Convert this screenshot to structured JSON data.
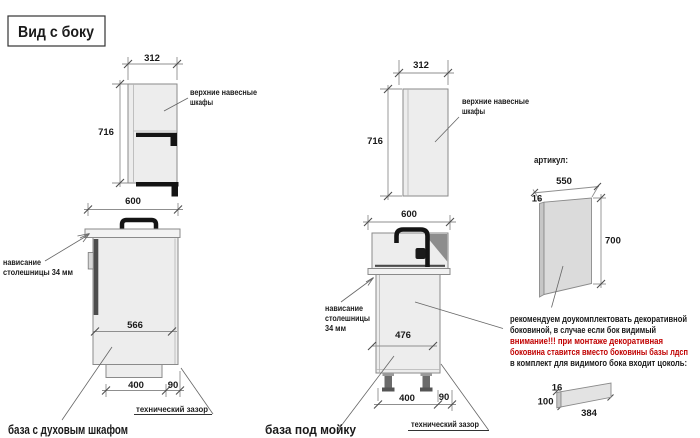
{
  "title": "Вид с боку",
  "colors": {
    "warning_red": "#c00000",
    "ink": "#1a1a1a",
    "drawing_line": "#8a8a8a",
    "cabinet_fill": "#ededed"
  },
  "upper_cabinet_left": {
    "width": "312",
    "height": "716",
    "label_line1": "верхние навесные",
    "label_line2": "шкафы"
  },
  "upper_cabinet_mid": {
    "width": "312",
    "height": "716",
    "label_line1": "верхние навесные",
    "label_line2": "шкафы"
  },
  "oven_base": {
    "top_width": "600",
    "inner_depth": "566",
    "plinth_width": "400",
    "tech_gap": "90",
    "overhang_line1": "нависание",
    "overhang_line2": "столешницы 34 мм",
    "tech_gap_label": "технический зазор",
    "caption": "база с духовым шкафом"
  },
  "sink_base": {
    "top_width": "600",
    "inner_depth": "476",
    "plinth_width": "400",
    "tech_gap": "90",
    "overhang_line1": "нависание",
    "overhang_line2": "столешницы",
    "overhang_line3": "34 мм",
    "tech_gap_label": "технический зазор",
    "caption": "база под мойку"
  },
  "decor_panel": {
    "header": "артикул:",
    "width": "550",
    "thickness": "16",
    "height": "700"
  },
  "note": {
    "line1": "рекомендуем доукомплектовать декоративной",
    "line2": "боковиной, в случае если бок видимый",
    "line3": "внимание!!! при монтаже декоративная",
    "line4": "боковина ставится вместо боковины базы лдсп",
    "line5": "в комплект для видимого бока входит цоколь:"
  },
  "plinth_part": {
    "thickness": "16",
    "height": "100",
    "length": "384"
  }
}
